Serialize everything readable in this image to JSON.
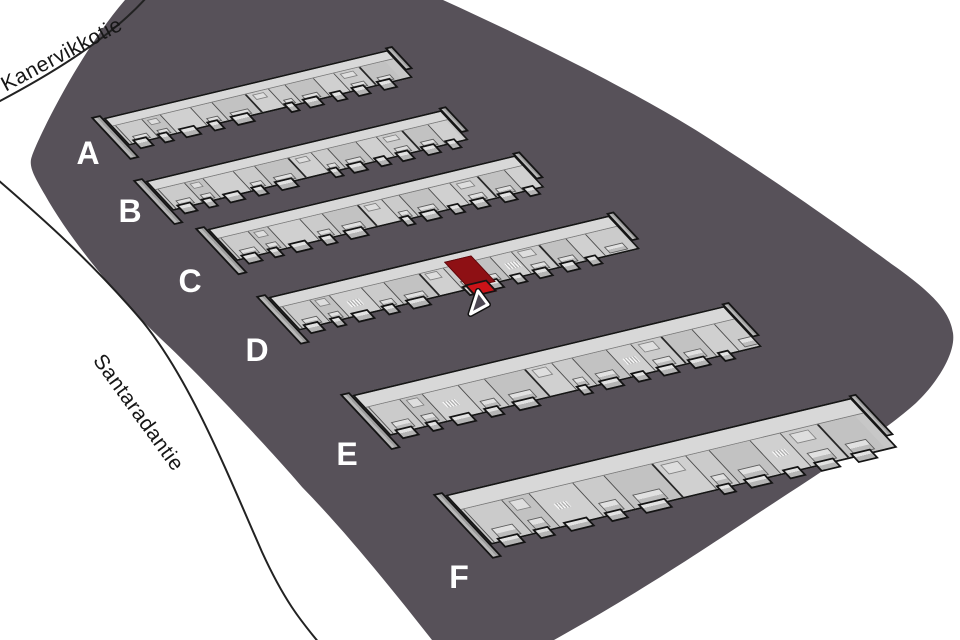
{
  "canvas": {
    "width": 960,
    "height": 640,
    "background": "#ffffff"
  },
  "site": {
    "fill": "#575159",
    "path": "M 125,0 L 443,0 C 540,44 642,96 702,134 C 790,190 856,238 893,265 C 934,294 950,312 953,333 C 956,354 936,384 916,403 C 884,432 818,474 760,512 C 700,552 640,592 554,640 L 432,640 C 388,584 344,530 302,487 C 278,458 200,375 160,338 C 120,300 70,240 45,195 C 34,176 28,166 32,156 C 38,138 80,52 125,0 Z"
  },
  "roads": [
    {
      "name": "kanervikkotie-edge",
      "path": "M 146,-2 C 112,36 55,72 -2,102"
    },
    {
      "name": "santaradantie-edge",
      "path": "M -2,180 C 42,218 92,262 143,322 C 190,380 226,470 262,552 C 284,600 300,620 320,644"
    }
  ],
  "streets": [
    {
      "name": "Kanervikkotie",
      "x": 62,
      "y": 55,
      "rotation": -28
    },
    {
      "name": "Santaradantie",
      "x": 138,
      "y": 413,
      "rotation": 54
    }
  ],
  "buildings": [
    {
      "label": "A",
      "x": 103,
      "y": 118,
      "length": 292,
      "depth": 38,
      "unit_scale": 1.0,
      "label_x": 88,
      "label_y": 153
    },
    {
      "label": "B",
      "x": 145,
      "y": 181,
      "length": 304,
      "depth": 41,
      "unit_scale": 1.0,
      "label_x": 130,
      "label_y": 211
    },
    {
      "label": "C",
      "x": 207,
      "y": 229,
      "length": 316,
      "depth": 44,
      "unit_scale": 1.05,
      "label_x": 190,
      "label_y": 281
    },
    {
      "label": "D",
      "x": 268,
      "y": 297,
      "length": 350,
      "depth": 46,
      "unit_scale": 1.05,
      "label_x": 257,
      "label_y": 350,
      "highlight": {
        "position": 0.495,
        "width": 28,
        "roof_color": "#8e1014",
        "face_color": "#cb1318"
      }
    },
    {
      "label": "E",
      "x": 352,
      "y": 395,
      "length": 382,
      "depth": 56,
      "unit_scale": 1.2,
      "label_x": 347,
      "label_y": 454
    },
    {
      "label": "F",
      "x": 445,
      "y": 495,
      "length": 417,
      "depth": 68,
      "unit_scale": 1.45,
      "label_x": 459,
      "label_y": 577
    }
  ],
  "colors": {
    "site_ground": "#575159",
    "roof_light": "#d8d8d8",
    "roof_mid": "#c7c7c7",
    "outline": "#161616",
    "building_label": "#ffffff",
    "street_text": "#161616",
    "selected_unit_roof": "#8e1014",
    "selected_unit_face": "#cb1318"
  },
  "cursor": {
    "x": 478,
    "y": 291,
    "points": "478,291 470.5,314 488,304.5",
    "fill": "#4c4652",
    "outline_inner": "#ffffff",
    "outline_outer": "#101010"
  }
}
